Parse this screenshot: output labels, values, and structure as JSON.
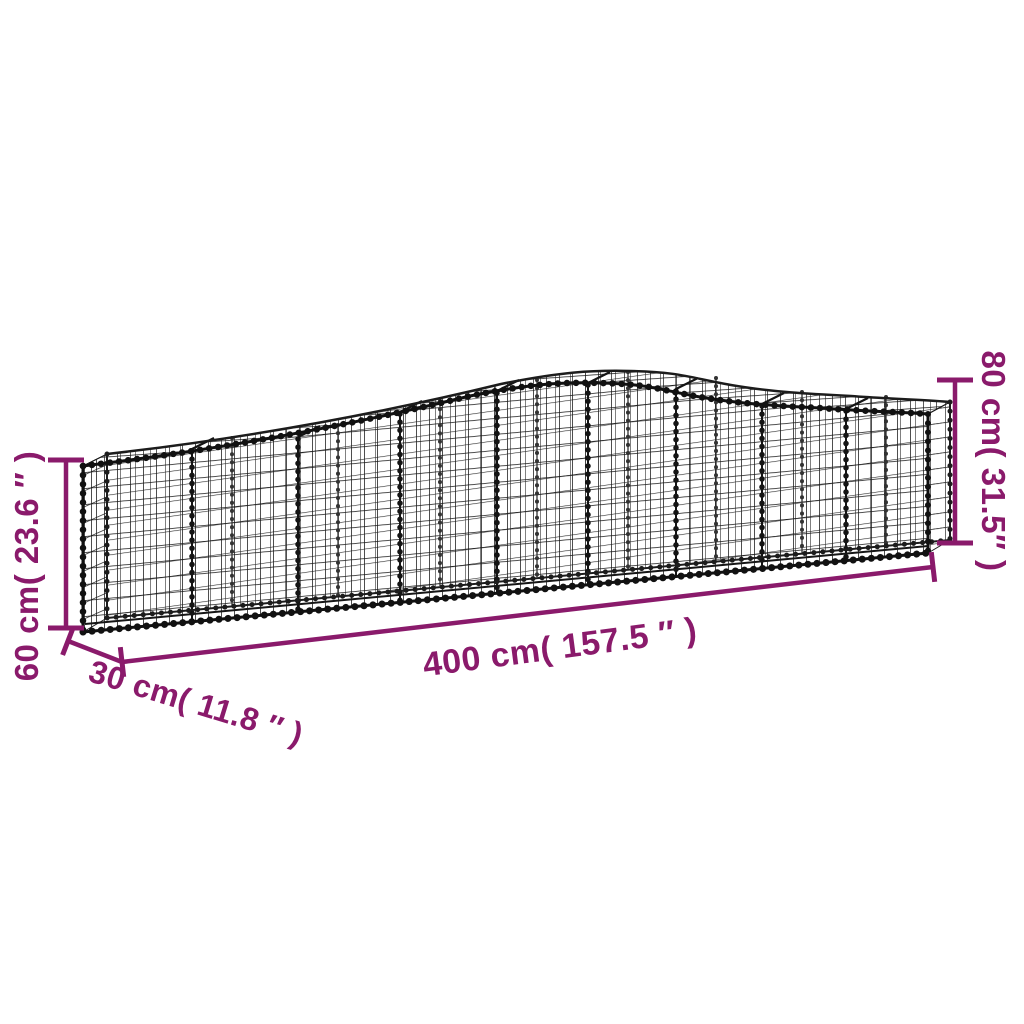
{
  "diagram": {
    "background_color": "#FFFFFF",
    "wire_color": "#141414",
    "annotation_color": "#8A1A6B",
    "dimensions": {
      "length": {
        "cm": "400",
        "inches": "157.5",
        "label": "400 cm( 157.5 ″ )"
      },
      "end_height": {
        "cm": "60",
        "inches": "23.6",
        "label": "60 cm( 23.6 ″ )"
      },
      "middle_height": {
        "cm": "80",
        "inches": "31.5",
        "label": "80 cm( 31.5″ )"
      },
      "depth": {
        "cm": "30",
        "inches": "11.8",
        "label": "30 cm( 11.8 ″ )"
      }
    }
  }
}
